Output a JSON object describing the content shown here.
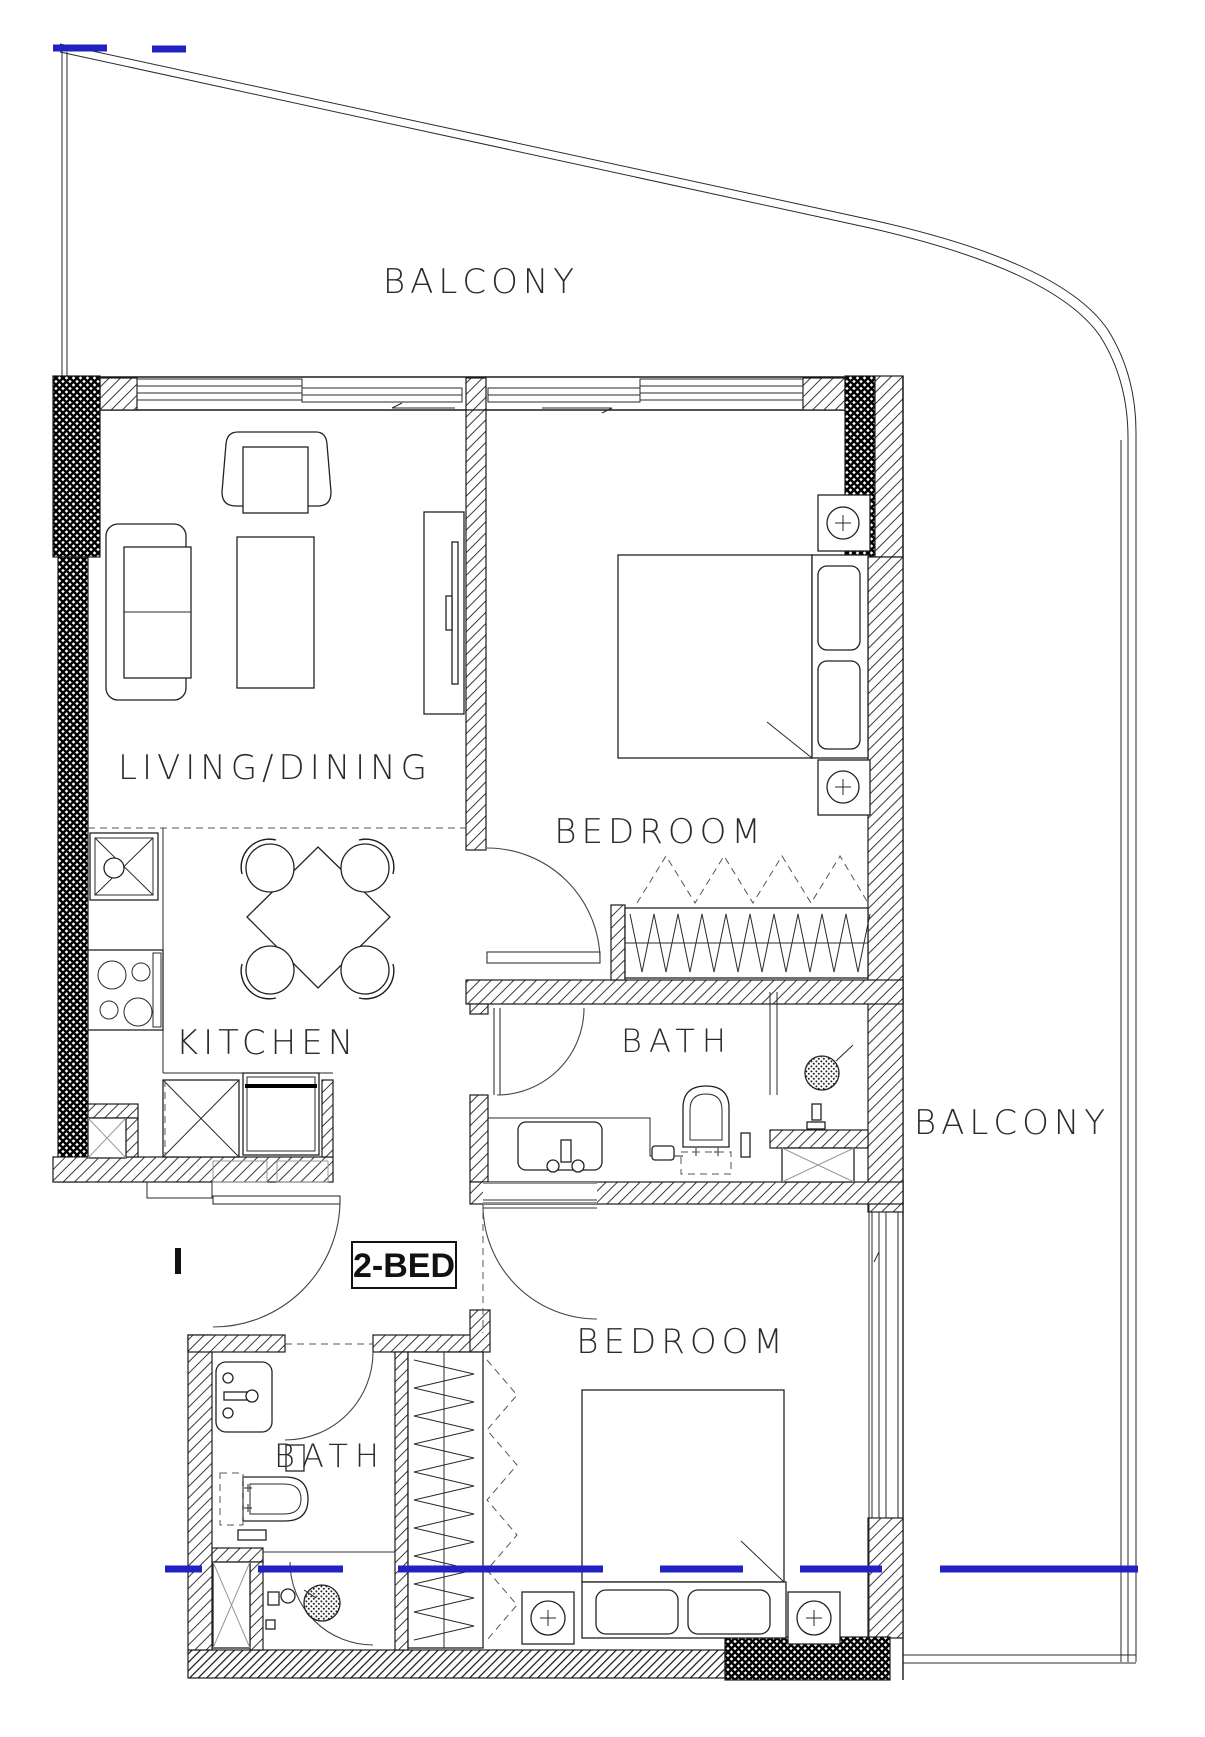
{
  "drawing": {
    "type": "architectural-floor-plan",
    "unit": {
      "label": "2-BED"
    },
    "rooms": [
      {
        "id": "balcony-top",
        "label": "BALCONY"
      },
      {
        "id": "living-dining",
        "label": "LIVING/DINING"
      },
      {
        "id": "bedroom-1",
        "label": "BEDROOM"
      },
      {
        "id": "kitchen",
        "label": "KITCHEN"
      },
      {
        "id": "bath-1",
        "label": "BATH"
      },
      {
        "id": "balcony-right",
        "label": "BALCONY"
      },
      {
        "id": "bedroom-2",
        "label": "BEDROOM"
      },
      {
        "id": "bath-2",
        "label": "BATH"
      }
    ],
    "colors": {
      "line": "#1b1b1b",
      "annotation_blue": "#2121c4",
      "background": "#ffffff"
    }
  }
}
